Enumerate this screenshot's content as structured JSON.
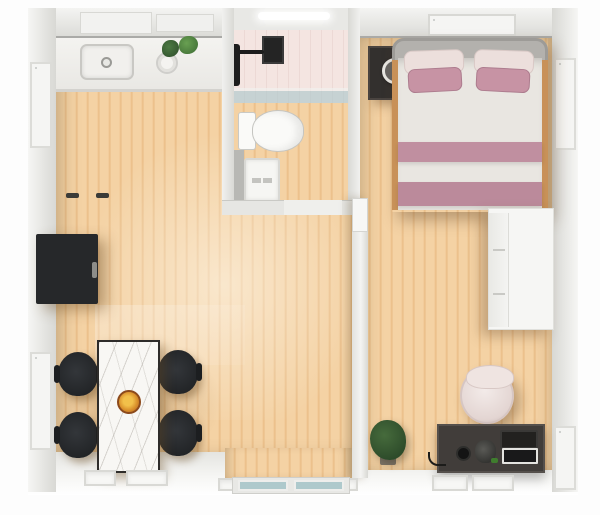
{
  "meta": {
    "title": "Top-down 3D render of a one-bedroom apartment",
    "view": "overhead interior render",
    "visible_text": "none"
  },
  "palette": {
    "wall": "#ebebe9",
    "wall-dark": "#d9d9d5",
    "wall-edge": "#aaaaa7",
    "window-frame": "#f5f5f3",
    "floor-light": "#f4d2a4",
    "floor-mid": "#efc794",
    "floor-dark": "#e8bb85",
    "tile-pink": "#f4e5e1",
    "glass-teal": "#aec9cc",
    "counter-white": "#f2f1ee",
    "cabinet-black": "#26282a",
    "chair-black": "#1c1e20",
    "table-marble": "#f8f7f4",
    "bowl-orange": "#d98f2b",
    "bed-duvet": "#e9e6e1",
    "bed-stripe": "#c08fa0",
    "pillow-mauve": "#c793a4",
    "pillow-blush": "#ecdfdc",
    "headboard-gray": "#b3b1ad",
    "nightstand-dark": "#33302e",
    "lamp-tan": "#d9a368",
    "wardrobe-white": "#f6f6f4",
    "desk-dark": "#413d3a",
    "chair-blush": "#e3d5d2",
    "plant-green": "#2d4b2a",
    "toilet-white": "#fafaf8"
  },
  "rooms": [
    {
      "id": "living-dining-kitchen",
      "label": "Living / dining / kitchen area with wood floor"
    },
    {
      "id": "bathroom",
      "label": "Bathroom with pink tiled shower, glass screen, toilet and mat"
    },
    {
      "id": "bedroom",
      "label": "Bedroom with double bed, nightstand, wardrobe, desk and chair"
    }
  ],
  "inventory": {
    "kitchen": [
      "counter",
      "sink with faucet",
      "round pot",
      "two herb plants",
      "range hood panels"
    ],
    "living": [
      "black cabinet on left wall",
      "marble dining table",
      "food bowl",
      "four black chairs",
      "sliding glass balcony door"
    ],
    "bathroom": [
      "ceiling light",
      "black shower fixture",
      "dark vanity panel",
      "glass shower screen",
      "toilet",
      "white floor mat",
      "door threshold with hinges"
    ],
    "bedroom": [
      "gray headboard bed with mauve striped duvet",
      "two blush pillows",
      "two mauve pillows",
      "dark nightstand",
      "ring lamp",
      "tan tray",
      "white drawer wardrobe",
      "blush round desk chair",
      "dark desk",
      "laptop",
      "mug",
      "gadget with green accent",
      "potted plant"
    ],
    "windows": [
      "left wall upper",
      "left wall lower",
      "right wall upper",
      "right wall lower",
      "top wall above bed"
    ]
  }
}
